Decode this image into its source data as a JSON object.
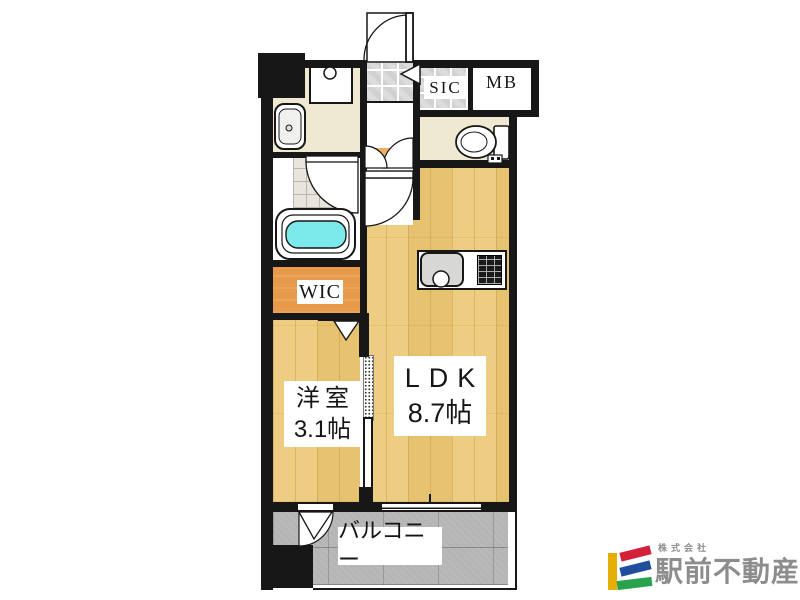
{
  "floorplan": {
    "labels": {
      "sic": "SIC",
      "mb": "MB",
      "wic": "WIC",
      "ldk_name": "LDK",
      "ldk_size": "8.7帖",
      "western_room_name": "洋室",
      "western_room_size": "3.1帖",
      "balcony": "バルコニー"
    },
    "colors": {
      "wall": "#171717",
      "wood_floor": "#ecc976",
      "cream_room": "#efe9d1",
      "orange_closet": "#e79b4a",
      "entry_step": "#ecaf63",
      "tile_gray": "#dcdcdc",
      "balcony_gray": "#b5b5b5",
      "bath_water": "#7ce9ea"
    },
    "fixtures": [
      "entrance-door",
      "shoe-closet-door",
      "washing-machine-pan",
      "washbasin",
      "bathtub",
      "bathroom-door",
      "toilet",
      "kitchen-counter",
      "kitchen-sink",
      "gas-stove",
      "sliding-partition",
      "folding-closet-door",
      "balcony-door",
      "ldk-window"
    ]
  },
  "logo": {
    "company_prefix": "株式会社",
    "company_name": "駅前不動産",
    "mark_colors": {
      "yellow": "#e5af06",
      "red": "#d42039",
      "blue": "#1e4e9c",
      "green": "#28a24d"
    },
    "text_color": "#8d8d8d"
  }
}
